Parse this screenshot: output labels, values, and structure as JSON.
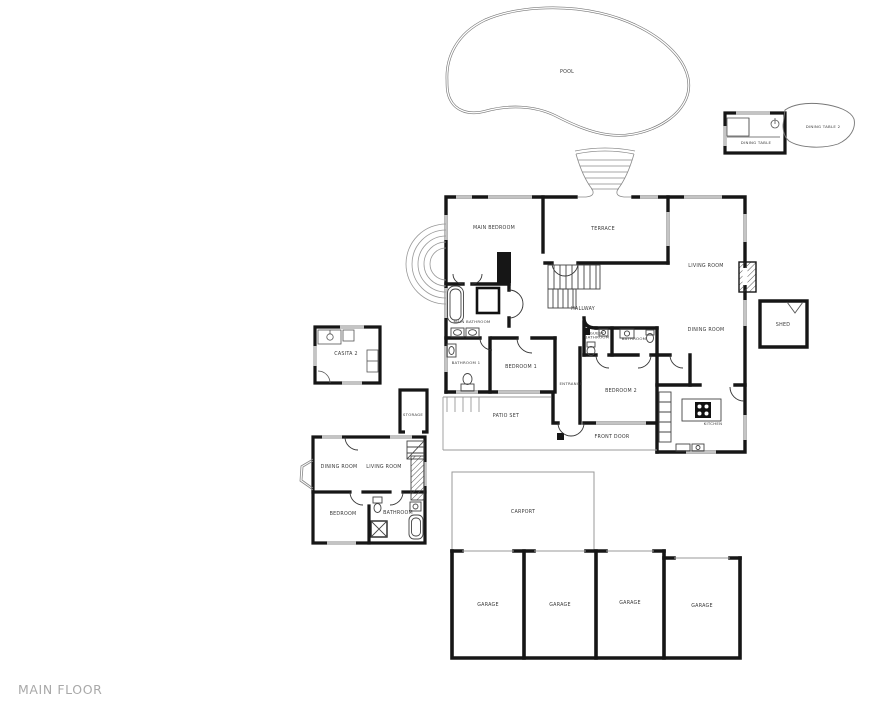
{
  "page": {
    "title": "MAIN FLOOR"
  },
  "rooms": {
    "pool": "POOL",
    "dining_table": "DINING TABLE",
    "dining_table_2": "DINING TABLE 2",
    "shed": "SHED",
    "main_bedroom": "MAIN BEDROOM",
    "terrace": "TERRACE",
    "living_room": "LIVING ROOM",
    "dining_room": "DINING ROOM",
    "hallway": "HALLWAY",
    "main_bathroom": "MAIN BATHROOM",
    "bathroom_1": "BATHROOM 1",
    "bedroom_1": "BEDROOM 1",
    "guest_bathroom": "GUEST BATHROOM",
    "bathroom": "BATHROOM",
    "bedroom_2": "BEDROOM 2",
    "entrance": "ENTRANCE",
    "kitchen": "KITCHEN",
    "patio_set": "PATIO SET",
    "front_door": "FRONT DOOR",
    "casita_2": "CASITA 2",
    "storage": "STORAGE",
    "gh_dining_room": "DINING ROOM",
    "gh_living_room": "LIVING ROOM",
    "gh_bedroom": "BEDROOM",
    "gh_bathroom": "BATHROOM",
    "carport": "CARPORT",
    "garages": [
      "GARAGE",
      "GARAGE",
      "GARAGE",
      "GARAGE"
    ]
  },
  "colors": {
    "wall": "#161616",
    "thin_line": "#999999",
    "window": "#c4c4c4",
    "label": "#3a3a3a",
    "floor_title": "#a9a9a9"
  }
}
